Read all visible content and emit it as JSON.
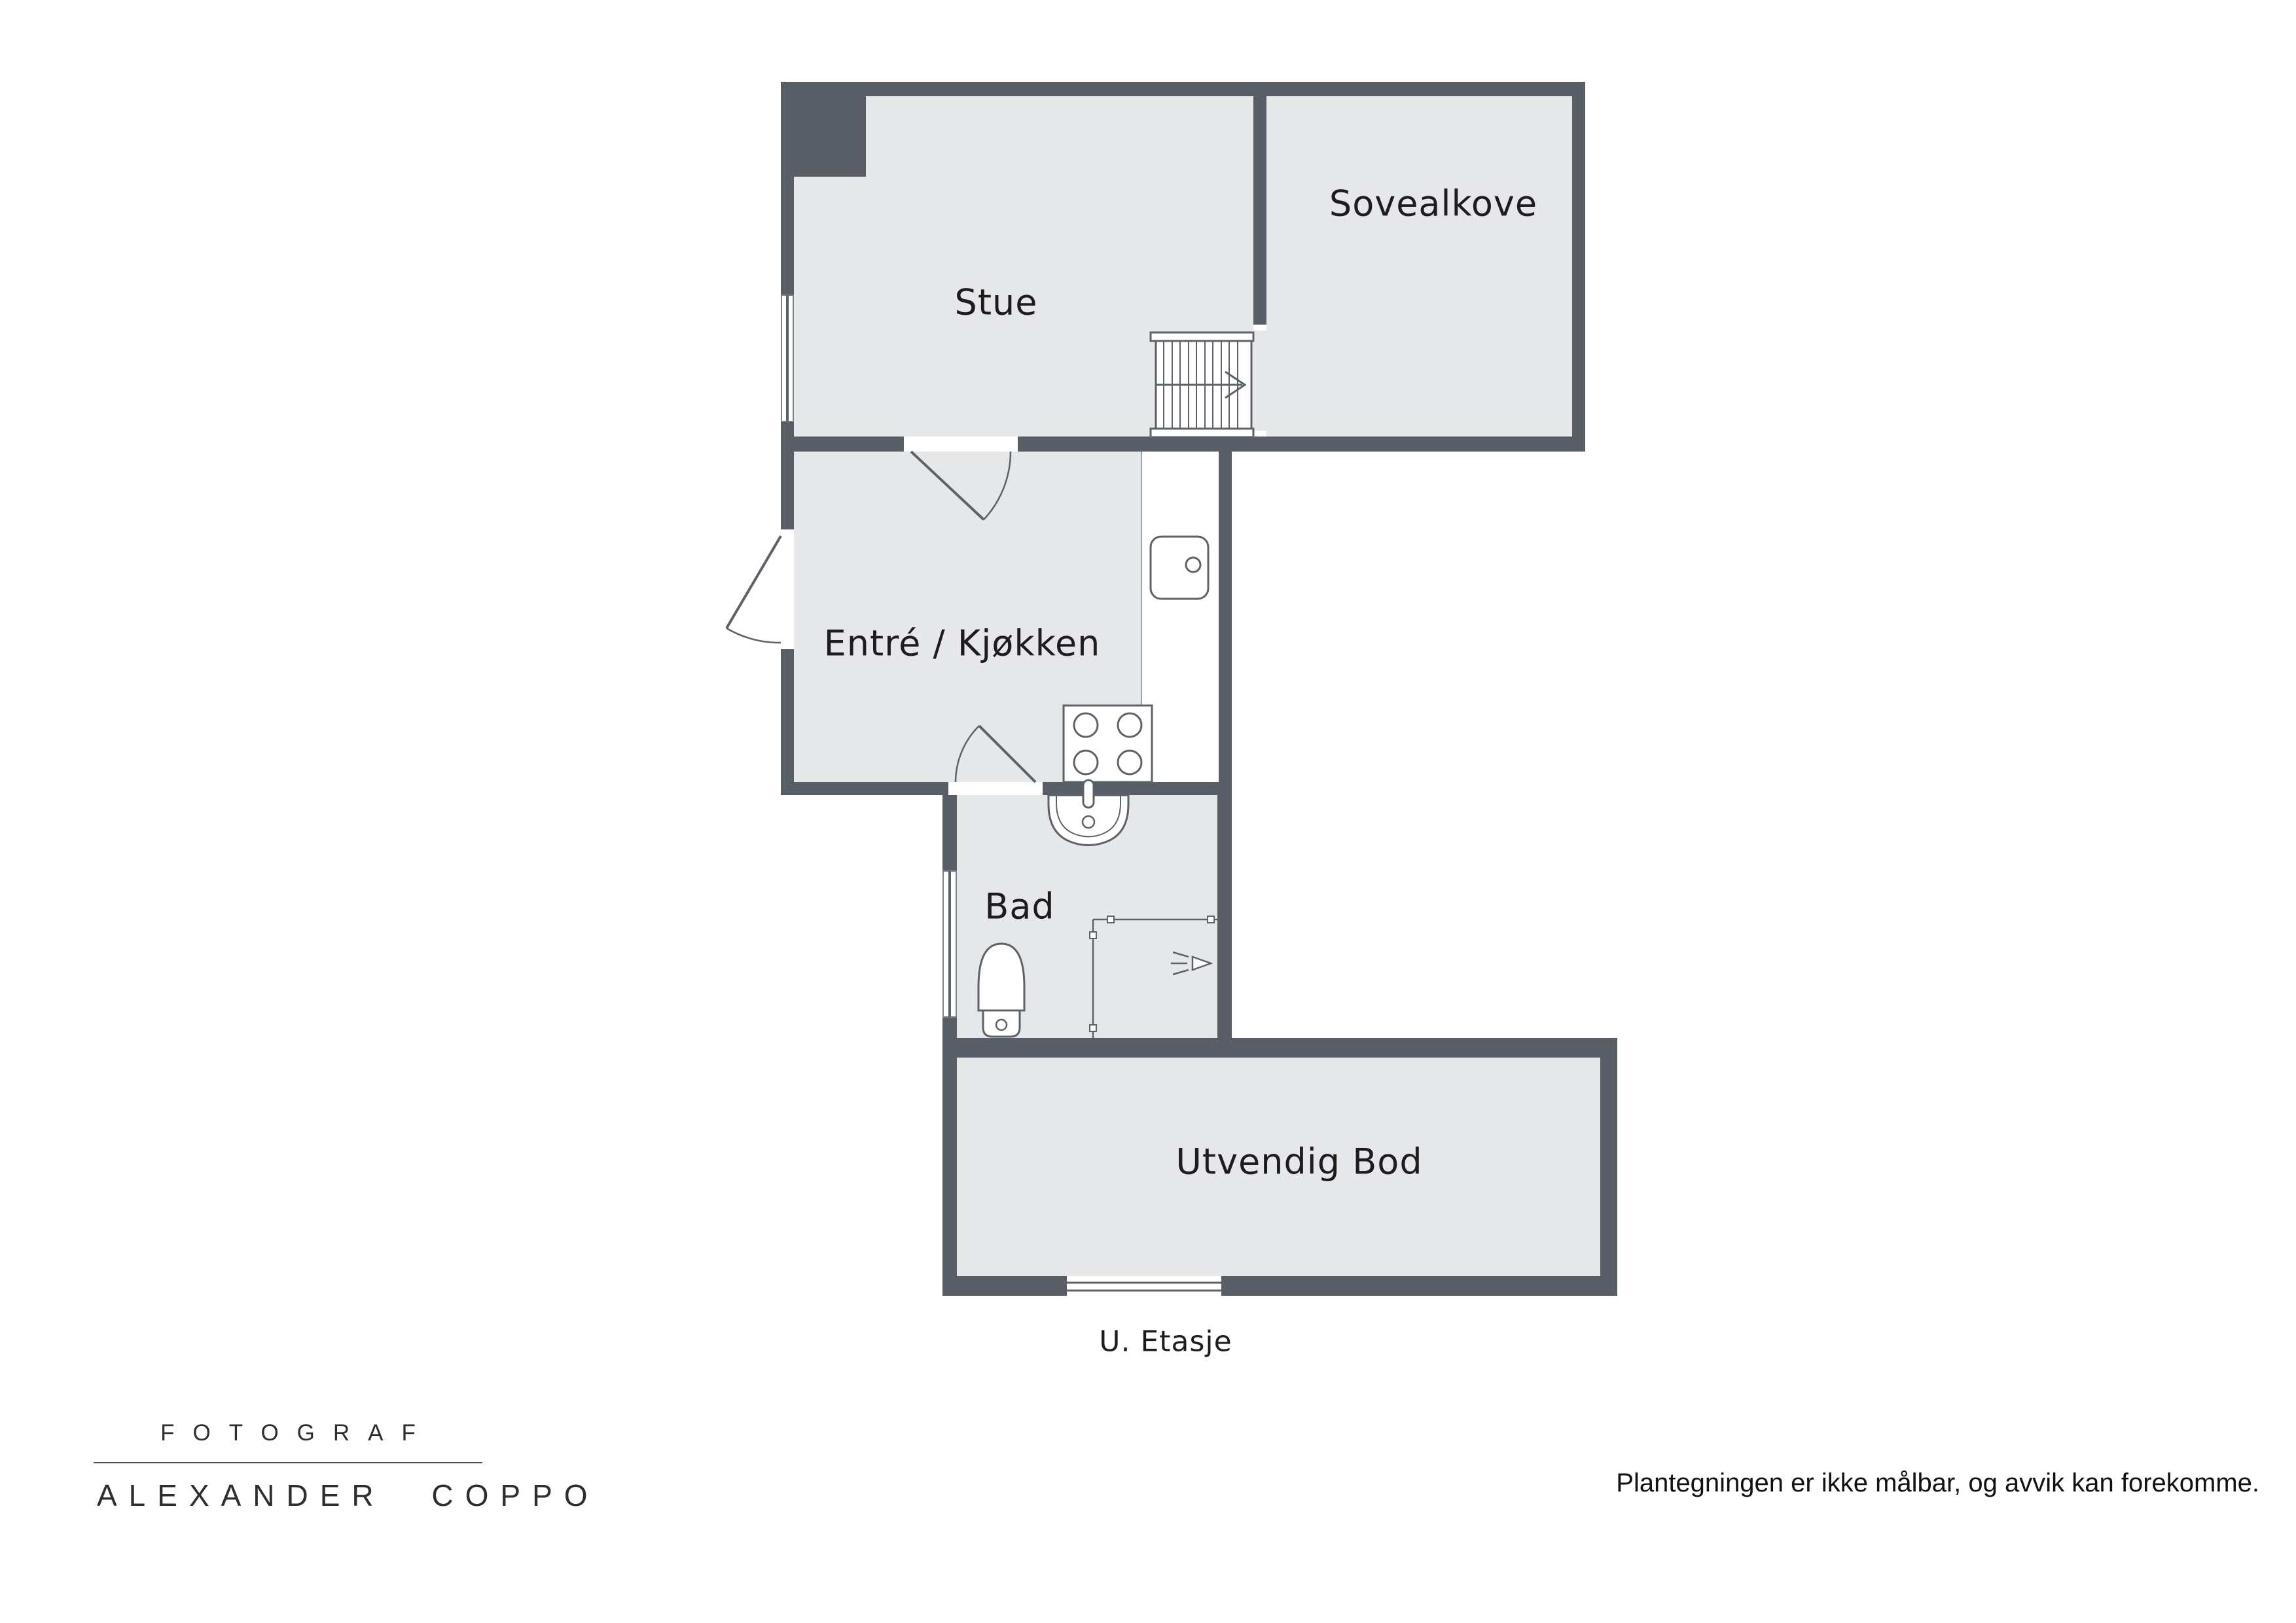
{
  "plan": {
    "rooms": {
      "stue": "Stue",
      "sovealkove": "Sovealkove",
      "entre_kjokken": "Entré / Kjøkken",
      "bad": "Bad",
      "utvendig_bod": "Utvendig Bod"
    },
    "floor_label": "U. Etasje",
    "fixtures": [
      "staircase-icon",
      "kitchen-sink-icon",
      "stove-icon",
      "bathroom-sink-icon",
      "toilet-icon",
      "shower-icon",
      "door-swing-icon",
      "window-icon"
    ]
  },
  "footer": {
    "logo": {
      "profession": "FOTOGRAF",
      "name": "ALEXANDER COPPO"
    },
    "disclaimer": "Plantegningen er ikke målbar, og avvik kan forekomme."
  },
  "colors": {
    "wall": "#595e66",
    "floor": "#e6e7e8",
    "outline": "#5d6269",
    "text": "#1d1d1f",
    "background": "#ffffff"
  }
}
